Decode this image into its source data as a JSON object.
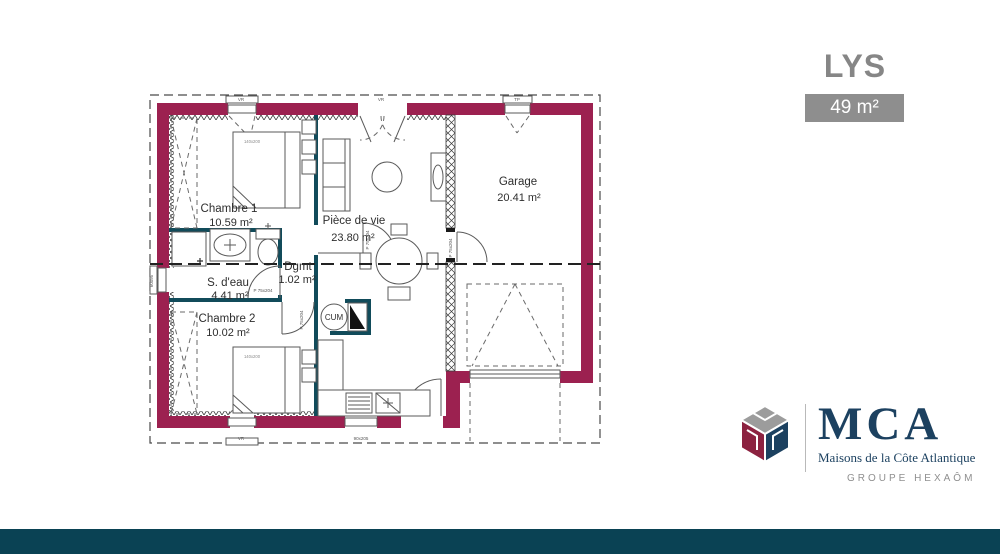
{
  "header": {
    "title": "LYS",
    "area_badge": "49 m²"
  },
  "plan": {
    "rooms": {
      "chambre1": {
        "name": "Chambre 1",
        "area": "10.59 m²"
      },
      "piece_de_vie": {
        "name": "Pièce de vie",
        "area": "23.80 m²"
      },
      "garage": {
        "name": "Garage",
        "area": "20.41 m²"
      },
      "s_deau": {
        "name": "S. d'eau",
        "area": "4.41 m²"
      },
      "degagement": {
        "name": "Dgmt",
        "area": "1.02 m²"
      },
      "chambre2": {
        "name": "Chambre 2",
        "area": "10.02 m²"
      }
    },
    "equipment": {
      "water_heater": "CUM",
      "bed1": "140x200",
      "bed2": "140x200"
    },
    "openings": {
      "door_label": "P 75x204",
      "window_top_1": "VR",
      "window_top_2": "VR",
      "window_top_3": "TP",
      "window_bottom_1": "VR",
      "window_bottom_2": "90x205",
      "window_left": "60x95"
    }
  },
  "logo": {
    "initials": "MCA",
    "tagline": "Maisons de la Côte Atlantique",
    "group": "GROUPE HEXAÔM"
  },
  "colors": {
    "wall": "#9C2150",
    "partition": "#114B5A",
    "footer": "#0A4254",
    "badge_bg": "#8E8E8E",
    "title_gray": "#868686",
    "navy": "#1C4160",
    "logo_gray": "#9C9C9C",
    "logo_maroon": "#8C2240"
  }
}
